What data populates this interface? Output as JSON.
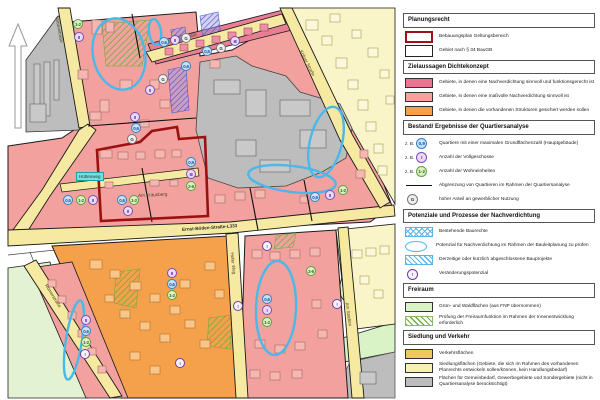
{
  "colors": {
    "cloud_blue": "#49B8EA",
    "boundary_red": "#A11015",
    "pink_dark": "#EC7490",
    "pink_light": "#F5A29C",
    "orange": "#F5A04B",
    "road_yellow": "#F6E9A2",
    "gray": "#BDBDBD",
    "green_light": "#D9F2C6",
    "gold": "#EFC75A",
    "pale_yellow": "#F8F2B2",
    "hatch_green": "#6FAE3E",
    "hatch_blue": "#5AB4E4"
  },
  "map": {
    "north_arrow_icon": "north-arrow",
    "streets": [
      "Hüttenstraße",
      "Kirchener Straße",
      "Kölner Straße",
      "Ernst-Böden-Straße-L333",
      "Hofer Weg",
      "Römerstraße",
      "Am Stadion",
      "Am Kräusberg"
    ],
    "teal_label": "Hüttenweg",
    "markers": [
      {
        "t": "un",
        "v": "1-2"
      },
      {
        "t": "fl",
        "v": "II"
      },
      {
        "t": "grz",
        "v": "0,6"
      },
      {
        "t": "fl",
        "v": "II"
      },
      {
        "t": "g",
        "v": "G"
      },
      {
        "t": "grz",
        "v": "0,5"
      },
      {
        "t": "g",
        "v": "G"
      },
      {
        "t": "fl",
        "v": "III"
      },
      {
        "t": "grz",
        "v": "0,9"
      },
      {
        "t": "g",
        "v": "G"
      },
      {
        "t": "fl",
        "v": "II"
      },
      {
        "t": "fl",
        "v": "II"
      },
      {
        "t": "grz",
        "v": "0,6"
      },
      {
        "t": "g",
        "v": "G"
      },
      {
        "t": "grz",
        "v": "0,9"
      },
      {
        "t": "fl",
        "v": "II"
      },
      {
        "t": "un",
        "v": "1-2"
      },
      {
        "t": "grz",
        "v": "0,5"
      },
      {
        "t": "un",
        "v": "1-2"
      },
      {
        "t": "fl",
        "v": "II"
      },
      {
        "t": "grz",
        "v": "0,6"
      },
      {
        "t": "un",
        "v": "1-2"
      },
      {
        "t": "fl",
        "v": "II"
      },
      {
        "t": "grz",
        "v": "0,9"
      },
      {
        "t": "fl",
        "v": "III"
      },
      {
        "t": "un",
        "v": "2-6"
      },
      {
        "t": "al",
        "v": "!"
      },
      {
        "t": "al",
        "v": "!"
      },
      {
        "t": "al",
        "v": "!"
      },
      {
        "t": "al",
        "v": "!"
      },
      {
        "t": "al",
        "v": "!"
      },
      {
        "t": "fl",
        "v": "II"
      },
      {
        "t": "grz",
        "v": "0,6"
      },
      {
        "t": "un",
        "v": "1-2"
      },
      {
        "t": "fl",
        "v": "II"
      },
      {
        "t": "grz",
        "v": "0,6"
      },
      {
        "t": "un",
        "v": "1-2"
      },
      {
        "t": "grz",
        "v": "0,6"
      },
      {
        "t": "fl",
        "v": "I"
      },
      {
        "t": "un",
        "v": "1-2"
      },
      {
        "t": "un",
        "v": "2-6"
      }
    ]
  },
  "legend": {
    "zb": "z. B.",
    "sections": [
      {
        "header": "Planungsrecht",
        "items": [
          {
            "label": "Bebauungsplan Geltungsbereich"
          },
          {
            "label": "Gebiet nach § 34 BauGB"
          }
        ]
      },
      {
        "header": "Zielaussagen Dichtekonzept",
        "items": [
          {
            "label": "Gebiete, in denen eine Nachverdichtung sinnvoll und funktionsgerecht ist"
          },
          {
            "label": "Gebiete, in denen eine maßvolle Nachverdichtung sinnvoll ist"
          },
          {
            "label": "Gebiete, in denen die vorhandenen Strukturen gesichert werden sollen"
          }
        ]
      },
      {
        "header": "Bestand/ Ergebnisse der Quartiersanalyse",
        "items": [
          {
            "symbol": "0,9",
            "label": "Quartiere mit einer maximalen Grundflächenzahl (Hauptgebäude)"
          },
          {
            "symbol": "I",
            "label": "Anzahl der Vollgeschosse"
          },
          {
            "symbol": "1-2",
            "label": "Anzahl der Wohneinheiten"
          },
          {
            "label": "Abgrenzung von Quartieren im Rahmen der Quartiersanalyse"
          },
          {
            "symbol": "G",
            "label": "hoher Anteil an gewerblicher Nutzung"
          }
        ]
      },
      {
        "header": "Potenziale und Prozesse der Nachverdichtung",
        "items": [
          {
            "label": "Bestehende Baurechte"
          },
          {
            "label": "Potenzial für Nachverdichtung im Rahmen der Bauleitplanung zu prüfen"
          },
          {
            "label": "Derzeitige oder kürzlich abgeschlossene Bauprojekte"
          },
          {
            "symbol": "!",
            "label": "Veränderungspotenzial"
          }
        ]
      },
      {
        "header": "Freiraum",
        "items": [
          {
            "label": "Grün- und Waldflächen (aus FNP übernommen)"
          },
          {
            "label": "Prüfung der Freiraumfunktion im Rahmen der Innenentwicklung erforderlich"
          }
        ]
      },
      {
        "header": "Siedlung und Verkehr",
        "items": [
          {
            "label": "Verkehrsflächen"
          },
          {
            "label": "Siedlungsflächen (Gebiete, die sich im Rahmen des vorhandenen Planrechts entwickeln sollen/können, kein Handlungsbedarf)"
          },
          {
            "label": "Flächen für Gemeinbedarf, Gewerbegebiete und Sondergebiete (nicht in Quartiersanalyse berücksichtigt)"
          }
        ]
      }
    ]
  }
}
